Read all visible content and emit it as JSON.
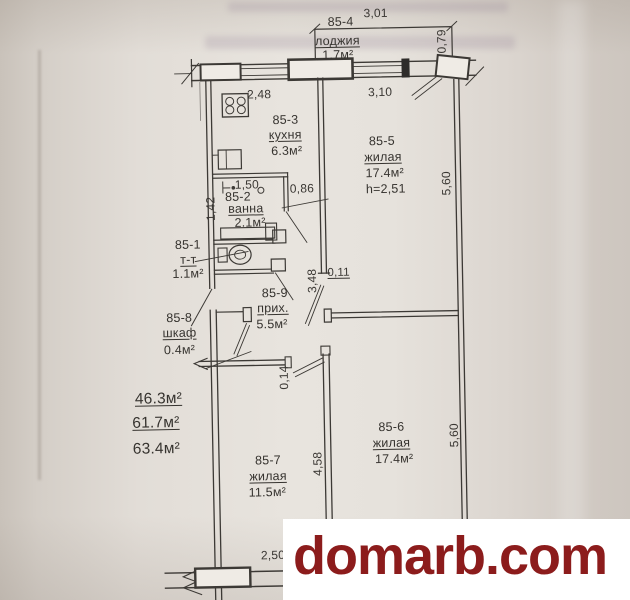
{
  "document_type": "apartment floor plan (scanned BTI drawing)",
  "watermark": {
    "text": "domarb.com"
  },
  "colors": {
    "watermark_text": "#8c1c1c",
    "watermark_bg": "#ffffff",
    "ink": "#3a3733",
    "paper": "#e2ddd7"
  },
  "plan": {
    "rooms": [
      {
        "id": "85-1",
        "name": "т-т",
        "area": "1.1м²"
      },
      {
        "id": "85-2",
        "name": "ванна",
        "area": "2.1м²"
      },
      {
        "id": "85-3",
        "name": "кухня",
        "area": "6.3м²"
      },
      {
        "id": "85-4",
        "name": "лоджия",
        "area": "1.7м²"
      },
      {
        "id": "85-5",
        "name": "жилая",
        "area": "17.4м²",
        "height_note": "h=2,51"
      },
      {
        "id": "85-6",
        "name": "жилая",
        "area": "17.4м²"
      },
      {
        "id": "85-7",
        "name": "жилая",
        "area": "11.5м²"
      },
      {
        "id": "85-8",
        "name": "шкаф",
        "area": "0.4м²"
      },
      {
        "id": "85-9",
        "name": "прих.",
        "area": "5.5м²"
      }
    ],
    "dims": {
      "lodge_width": "3,01",
      "lodge_depth": "0,79",
      "window_left": "2,48",
      "window_right": "3,10",
      "hall_wall": "0,86",
      "bath_width": "1,50",
      "bath_depth": "1,42",
      "kitchen_wall": "3,48",
      "pier_top": "0,11",
      "pier_bottom": "0,14",
      "room7_depth": "4,58",
      "right_wall_upper": "5,60",
      "right_wall_lower": "5,60",
      "bottom_window": "2,50"
    },
    "totals": {
      "living": "46.3м²",
      "subtotal": "61.7м²",
      "total": "63.4м²"
    }
  }
}
